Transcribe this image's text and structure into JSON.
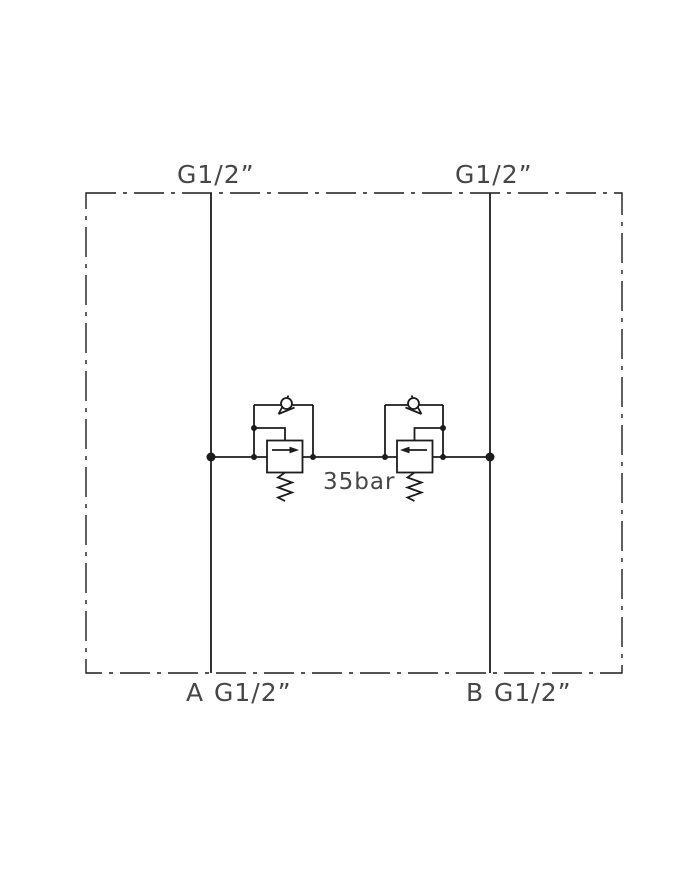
{
  "schematic": {
    "description": "Dual cross-line relief valve block schematic",
    "ports": {
      "top_left_thread": "G1/2”",
      "top_right_thread": "G1/2”",
      "bottom_left_letter": "A",
      "bottom_left_thread": "G1/2”",
      "bottom_right_letter": "B",
      "bottom_right_thread": "G1/2”"
    },
    "relief_setting": "35bar",
    "colors": {
      "line": "#1c1c1c",
      "text": "#464646",
      "background": "#ffffff"
    }
  }
}
